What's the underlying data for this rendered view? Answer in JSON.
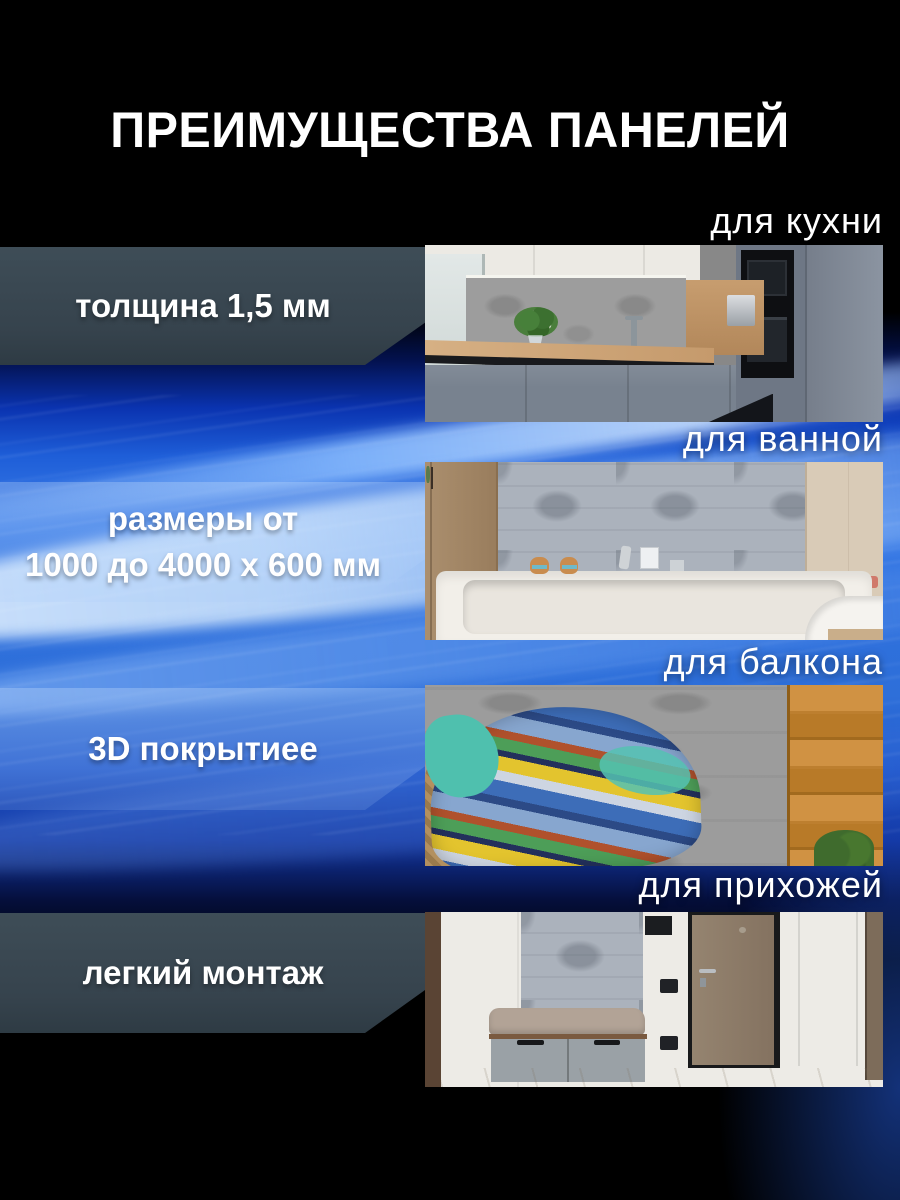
{
  "page": {
    "title": "ПРЕИМУЩЕСТВА ПАНЕЛЕЙ"
  },
  "features": [
    {
      "label": "толщина 1,5 мм"
    },
    {
      "label": "размеры от\n1000 до 4000 х 600 мм"
    },
    {
      "label": "3D покрытиее"
    },
    {
      "label": "легкий монтаж"
    }
  ],
  "sections": [
    {
      "caption": "для кухни",
      "scene": "kitchen"
    },
    {
      "caption": "для ванной",
      "scene": "bathroom"
    },
    {
      "caption": "для балкона",
      "scene": "balcony"
    },
    {
      "caption": "для прихожей",
      "scene": "hallway"
    }
  ],
  "colors": {
    "background_black": "#000000",
    "accent_blue": "#2e6fd9",
    "plate_dark": "#36434d",
    "text_white": "#ffffff"
  }
}
